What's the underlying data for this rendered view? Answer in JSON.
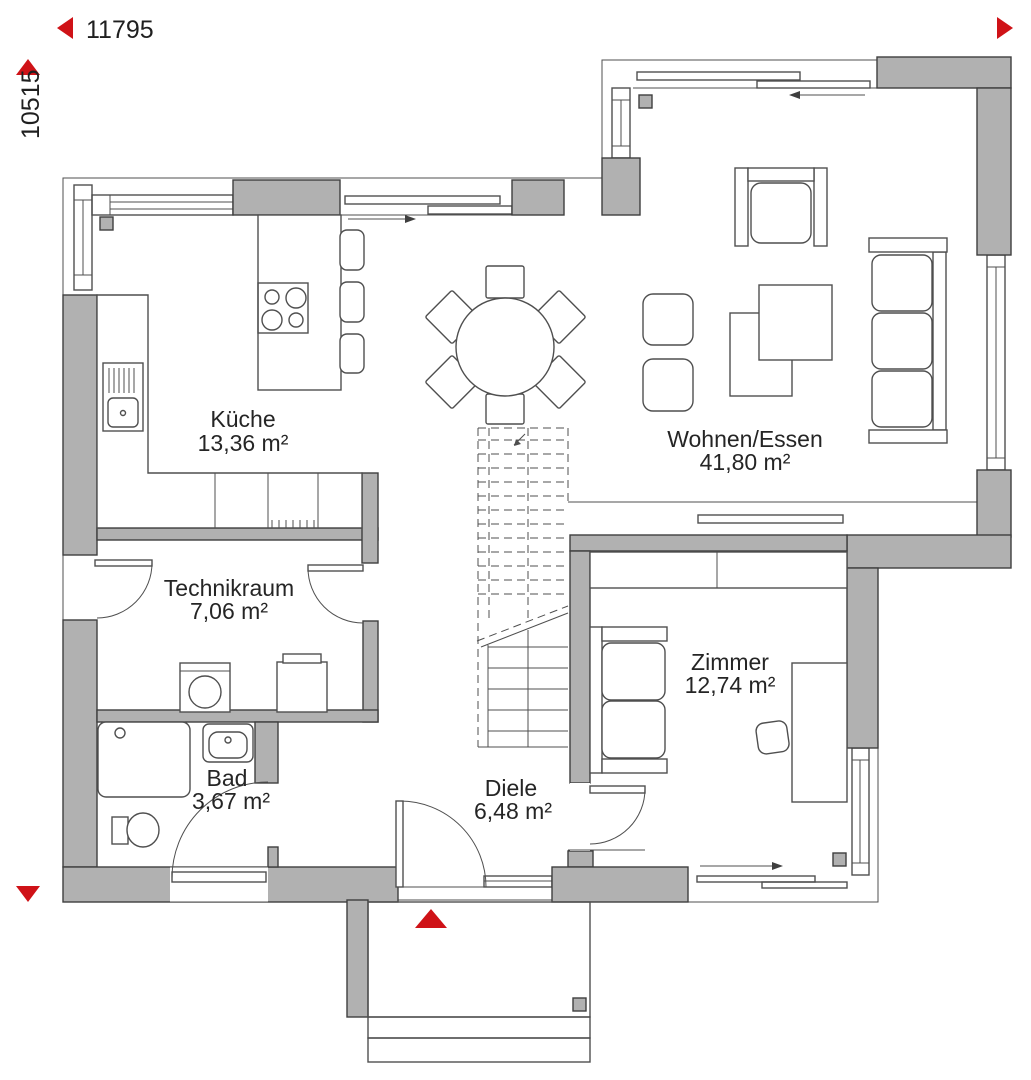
{
  "dimensions": {
    "width_label": "11795",
    "height_label": "10515"
  },
  "rooms": [
    {
      "id": "kueche",
      "name": "Küche",
      "area": "13,36 m²"
    },
    {
      "id": "wohnen",
      "name": "Wohnen/Essen",
      "area": "41,80 m²"
    },
    {
      "id": "technikraum",
      "name": "Technikraum",
      "area": "7,06 m²"
    },
    {
      "id": "zimmer",
      "name": "Zimmer",
      "area": "12,74 m²"
    },
    {
      "id": "bad",
      "name": "Bad",
      "area": "3,67 m²"
    },
    {
      "id": "diele",
      "name": "Diele",
      "area": "6,48 m²"
    }
  ],
  "colors": {
    "wall_fill": "#b1b1b1",
    "line": "#4f4f4f",
    "accent_red": "#cf1217",
    "text": "#252525",
    "background": "#ffffff"
  },
  "icons": {
    "dimension_arrows": "red-triangle",
    "entrance_marker": "red-triangle"
  }
}
